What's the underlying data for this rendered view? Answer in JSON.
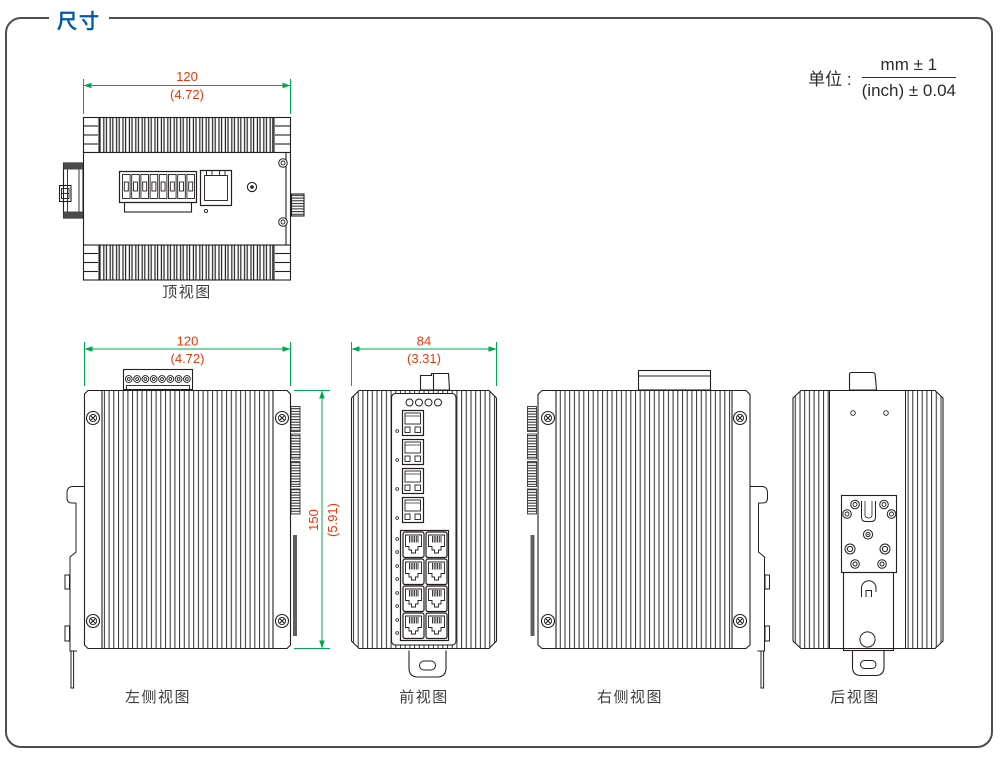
{
  "header": {
    "title": "尺寸"
  },
  "unit_note": {
    "label": "单位 :",
    "mm": "mm ± 1",
    "inch": "(inch) ± 0.04"
  },
  "views": {
    "top": {
      "label": "顶视图",
      "width_mm": "120",
      "width_inch": "(4.72)"
    },
    "left_side": {
      "label": "左侧视图",
      "width_mm": "120",
      "width_inch": "(4.72)",
      "height_mm": "150",
      "height_inch": "(5.91)"
    },
    "front": {
      "label": "前视图",
      "width_mm": "84",
      "width_inch": "(3.31)"
    },
    "right_side": {
      "label": "右侧视图"
    },
    "rear": {
      "label": "后视图"
    }
  },
  "colors": {
    "title_blue": "#0058b0",
    "dimension_line_green": "#00a651",
    "dimension_text_red": "#e8380d",
    "drawing_line": "#231f20",
    "frame_gray": "#4d4d4f"
  }
}
